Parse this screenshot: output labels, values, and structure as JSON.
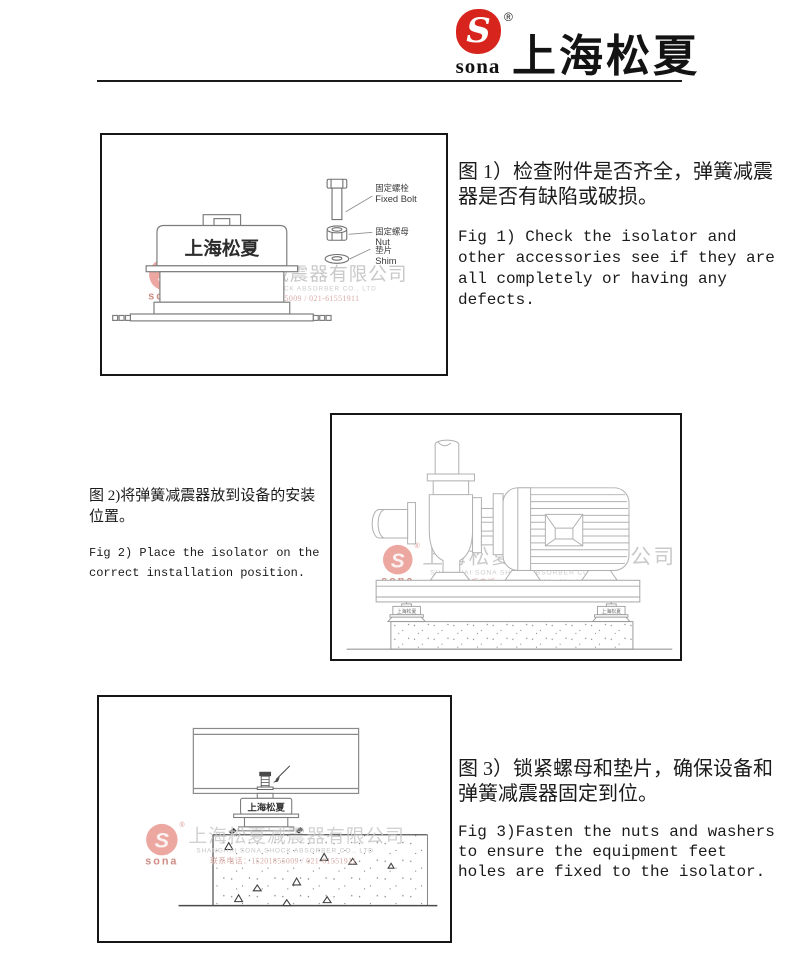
{
  "header": {
    "logo_text": "sona",
    "logo_glyph": "S",
    "registered_mark": "®",
    "brand_name": "上海松夏",
    "brand_color": "#d7251d"
  },
  "watermark": {
    "logo_text": "sona",
    "logo_glyph": "S",
    "registered_mark": "®",
    "line1": "上海松夏减震器有限公司",
    "line2": "SHANGHAI SONA SHOCK ABSORBER CO., LTD",
    "line3": "联系电话：15201855009 / 021-61551911",
    "text_color": "#c9c9c9",
    "contact_color": "#d9aba6"
  },
  "figure1": {
    "device_label": "上海松夏",
    "parts": [
      {
        "zh": "固定螺栓",
        "en": "Fixed Bolt"
      },
      {
        "zh": "固定螺母",
        "en": "Nut"
      },
      {
        "zh": "垫片",
        "en": "Shim"
      }
    ],
    "caption_zh": "图 1）检查附件是否齐全，弹簧减震\n器是否有缺陷或破损。",
    "caption_en": "Fig 1) Check the isolator and\nother accessories see if they are\nall completely or having any\ndefects."
  },
  "figure2": {
    "isolator_label": "上海松夏",
    "caption_zh": "图 2)将弹簧减震器放到设备的安装\n位置。",
    "caption_en": "Fig 2) Place the isolator on the\ncorrect installation position."
  },
  "figure3": {
    "device_label": "上海松夏",
    "caption_zh": "图 3）锁紧螺母和垫片，确保设备和\n弹簧减震器固定到位。",
    "caption_en": "Fig 3)Fasten the nuts and washers\nto ensure the equipment feet\nholes are fixed to the isolator."
  }
}
